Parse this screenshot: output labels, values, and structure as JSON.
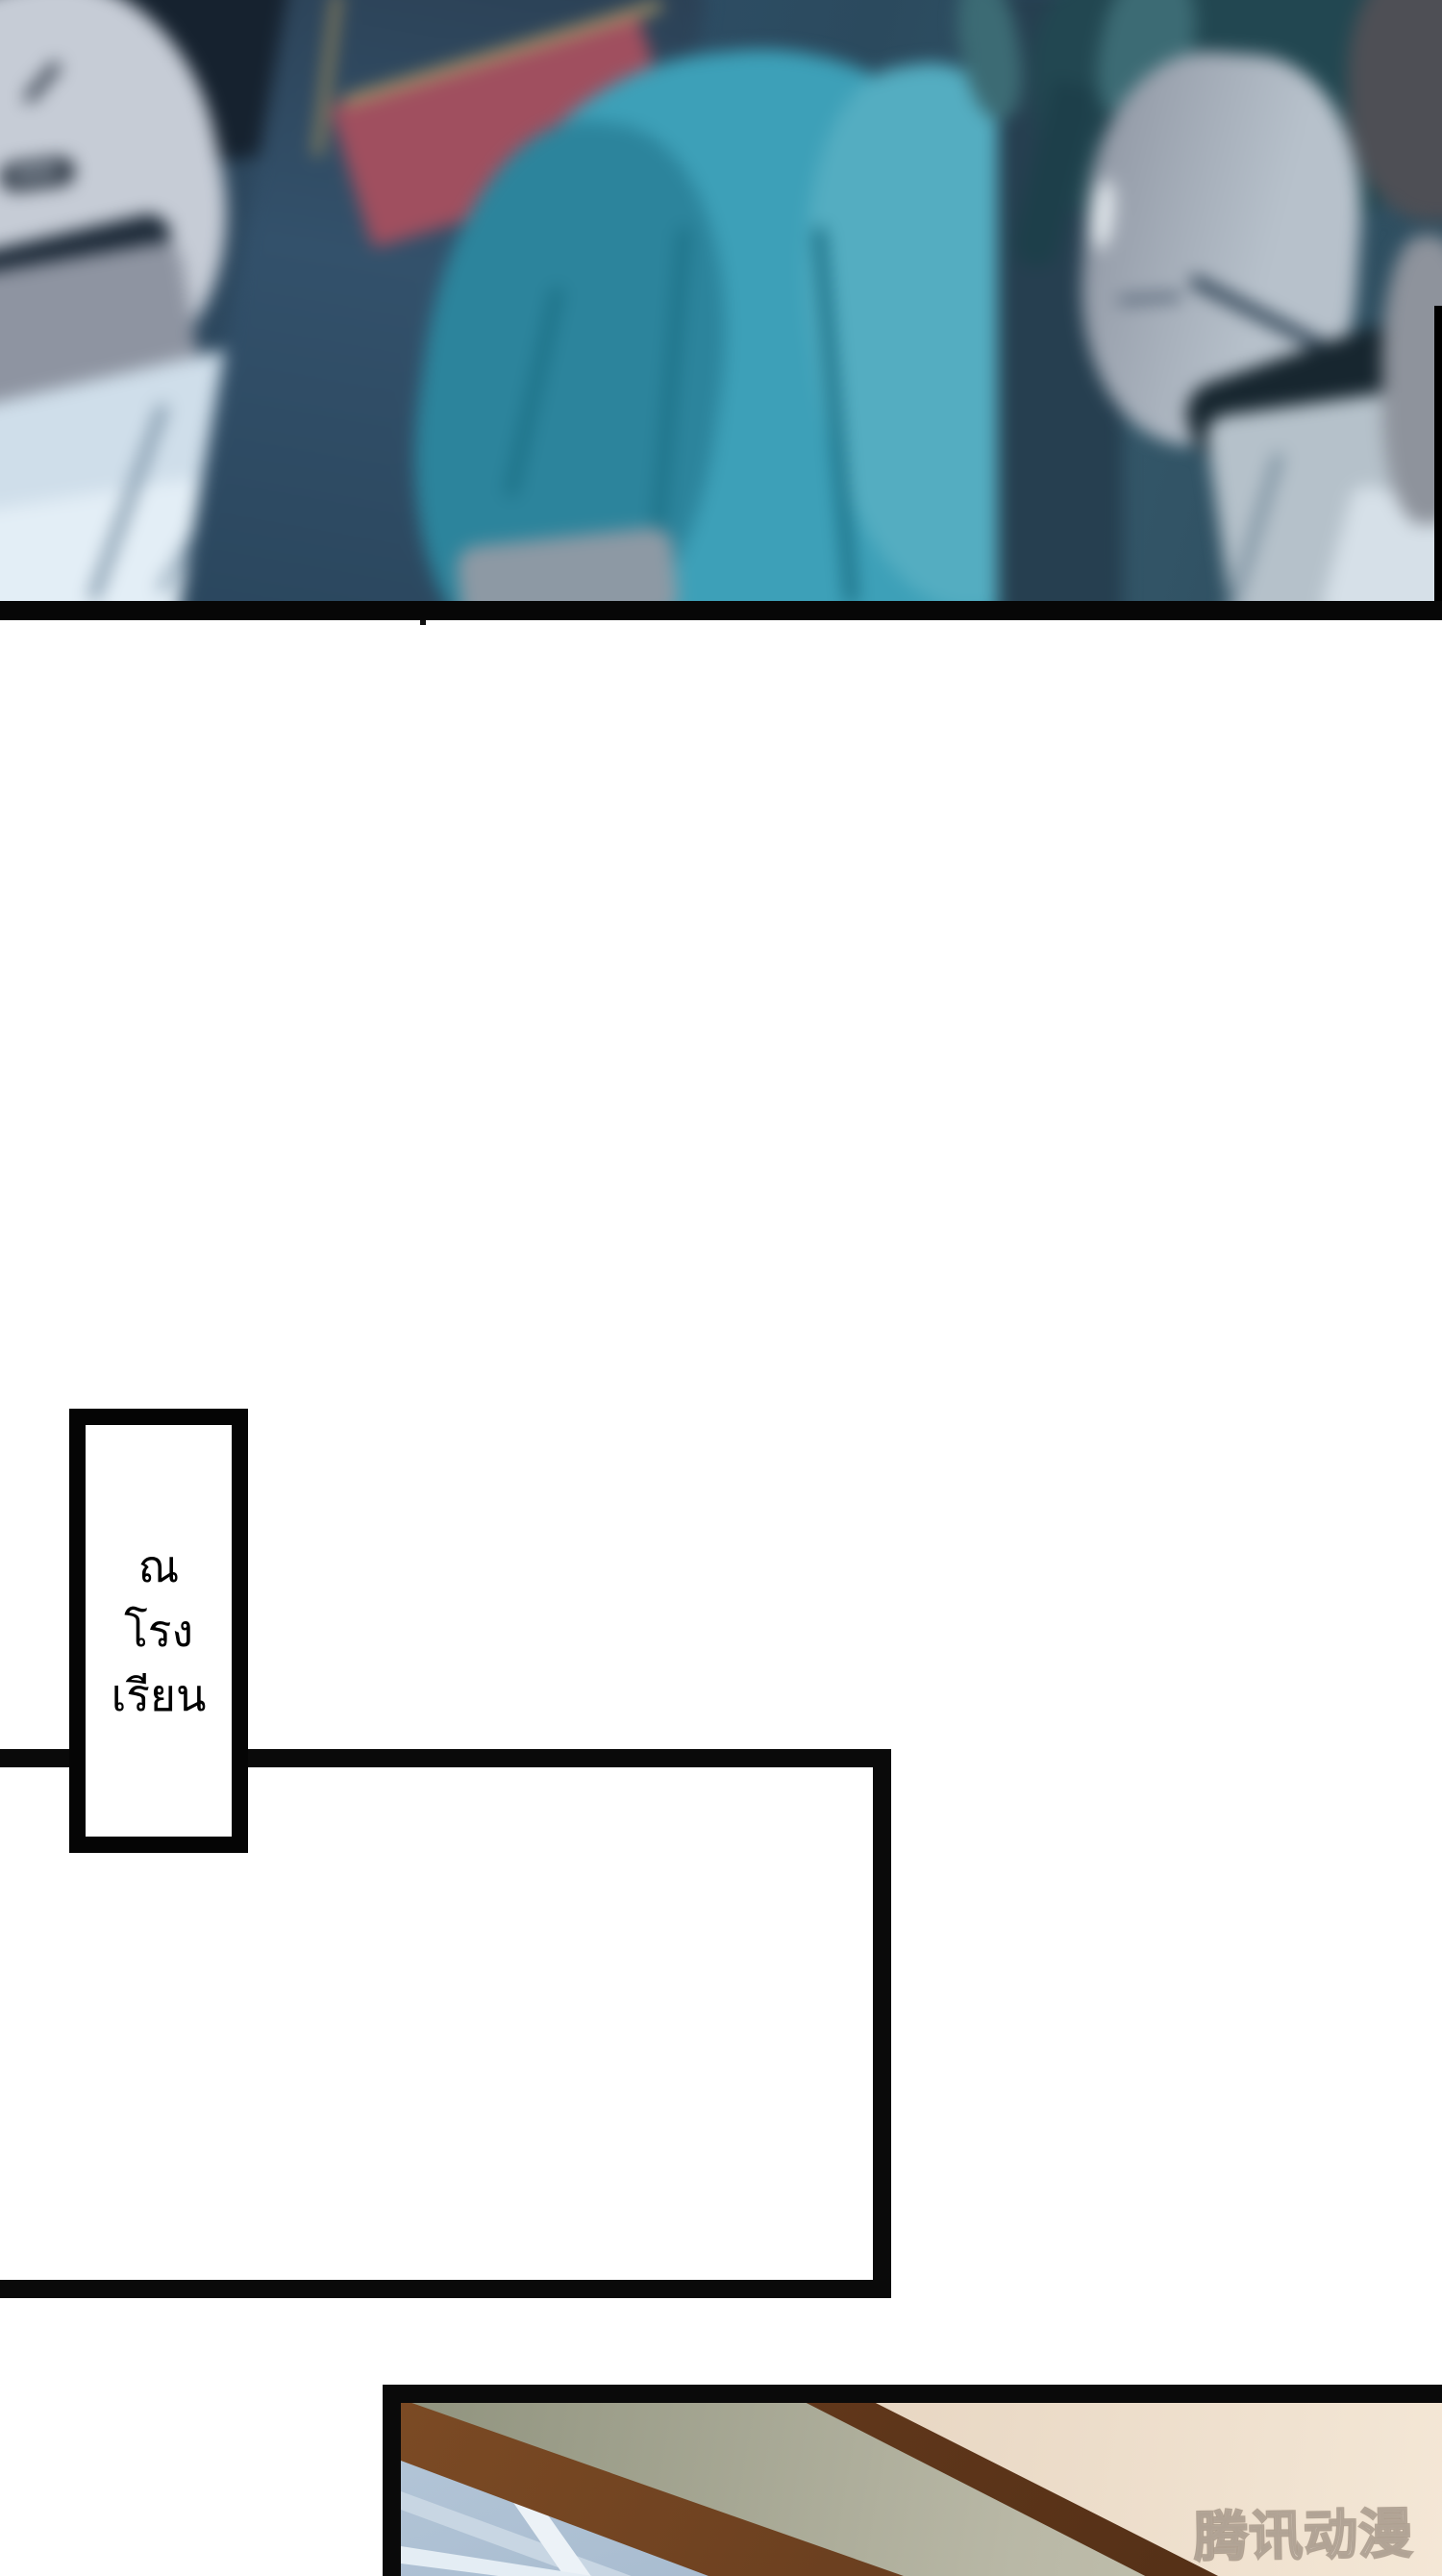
{
  "caption_box": {
    "lines": [
      "ณ",
      "โรง",
      "เรียน"
    ]
  },
  "bottom_panel": {
    "watermark": "腾讯动漫"
  },
  "colors": {
    "panel_border": "#0a0a0a",
    "caption_text": "#000000",
    "teal_hair": "#3da0b8",
    "collar_red": "#a04f5f",
    "gold_trim": "#a89566",
    "beam_brown": "#6b3d1e",
    "wall_beige": "#e8d7c3",
    "wall_sage": "#b9b8a6",
    "window_blue": "#aabfd3",
    "background_slate": "#30506a"
  }
}
